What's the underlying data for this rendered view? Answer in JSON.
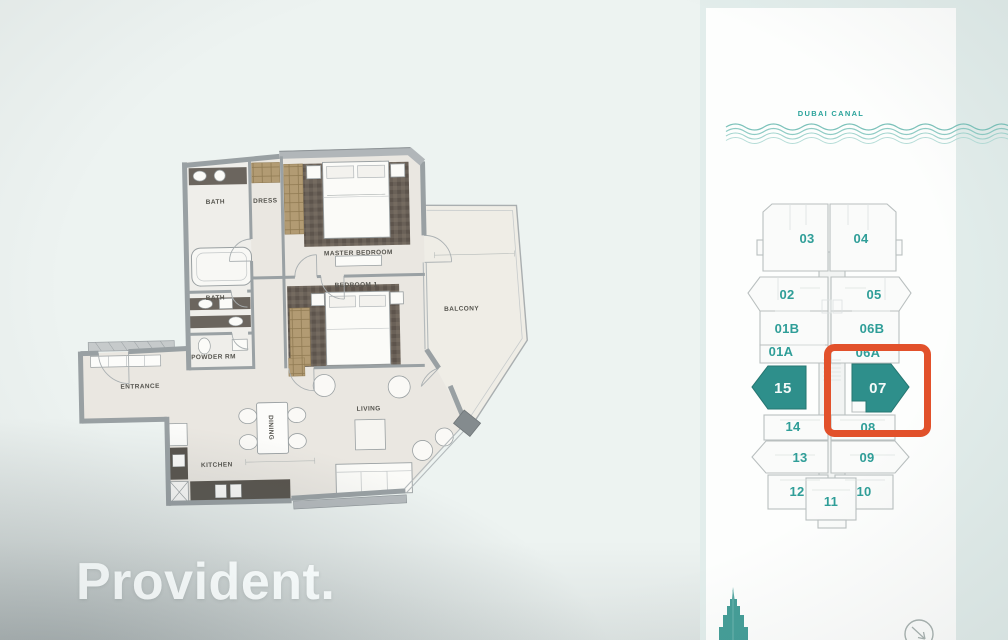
{
  "watermark": {
    "text": "Provident."
  },
  "floor_plan": {
    "rooms": [
      {
        "label": "BATH"
      },
      {
        "label": "DRESS"
      },
      {
        "label": "MASTER BEDROOM"
      },
      {
        "label": "BATH"
      },
      {
        "label": "BEDROOM 1"
      },
      {
        "label": "POWDER RM"
      },
      {
        "label": "ENTRANCE"
      },
      {
        "label": "KITCHEN"
      },
      {
        "label": "DINING"
      },
      {
        "label": "LIVING"
      },
      {
        "label": "BALCONY"
      }
    ]
  },
  "key_plan": {
    "canal_label": "DUBAI CANAL",
    "highlighted_unit": "07",
    "selected_units": [
      "15",
      "07"
    ],
    "highlight_color": "#e2512b",
    "selected_fill": "#2e8f8b",
    "label_color": "#2f9e98",
    "units": [
      {
        "id": "03"
      },
      {
        "id": "04"
      },
      {
        "id": "02"
      },
      {
        "id": "05"
      },
      {
        "id": "01B"
      },
      {
        "id": "06B"
      },
      {
        "id": "01A"
      },
      {
        "id": "06A"
      },
      {
        "id": "15"
      },
      {
        "id": "07"
      },
      {
        "id": "14"
      },
      {
        "id": "08"
      },
      {
        "id": "13"
      },
      {
        "id": "09"
      },
      {
        "id": "12"
      },
      {
        "id": "11"
      },
      {
        "id": "10"
      }
    ]
  },
  "icons": {
    "burj": "burj-khalifa-icon",
    "nav": "nav-arrow-icon"
  }
}
